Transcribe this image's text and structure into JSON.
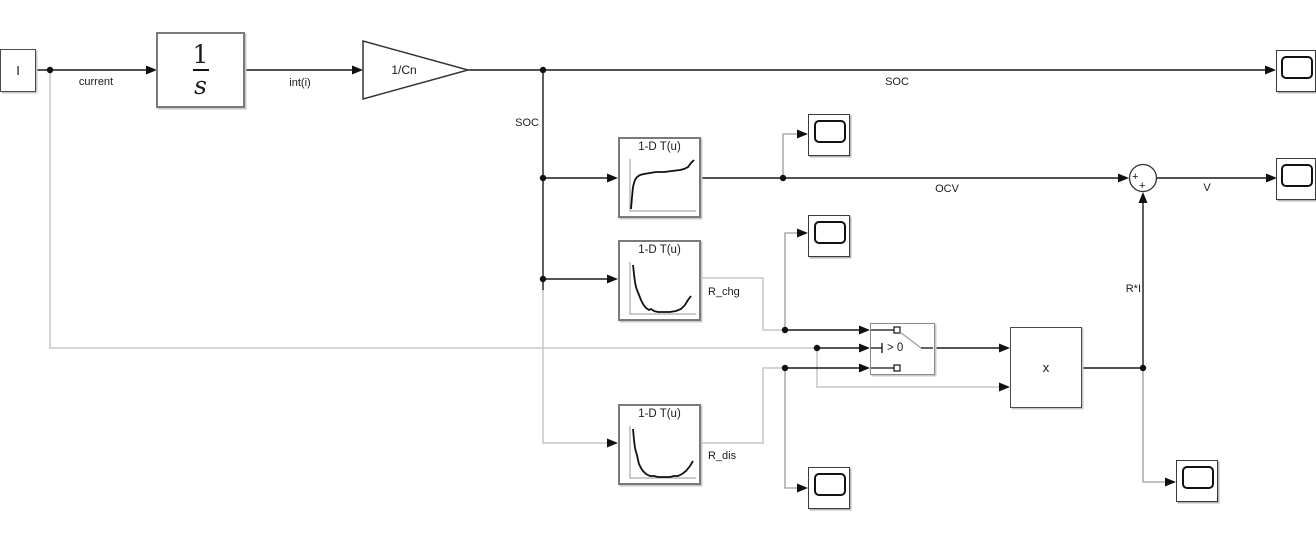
{
  "diagram_title": "battery model block diagram",
  "labels": {
    "current": "current",
    "int_i": "int(i)",
    "soc_branch": "SOC",
    "soc_top": "SOC",
    "ocv": "OCV",
    "r_chg": "R_chg",
    "r_dis": "R_dis",
    "r_times_i": "R*I",
    "v": "V"
  },
  "blocks": {
    "inport": {
      "label": "I"
    },
    "integrator": {
      "numerator": "1",
      "denominator": "s"
    },
    "gain": {
      "label": "1/Cn"
    },
    "luts": [
      {
        "title": "1-D T(u)",
        "curve_path": "M7,52 L8,40 L9,30 L10,26 L11,23 L13,20 L16,18 L20,17 L26,16 L32,15 L40,15 L48,14 L56,13 L60,12 L64,10 L67,6 L70,3",
        "signal": "OCV"
      },
      {
        "title": "1-D T(u)",
        "curve_path": "M9,5 L10,14 L11,22 L12,27 L13,30 L15,35 L17,40 L19,44 L22,48 L25,50 L27,49 L30,51 L34,52 L40,52 L46,52 L52,51 L57,49 L61,45 L64,40 L67,36",
        "signal": "R_chg"
      },
      {
        "title": "1-D T(u)",
        "curve_path": "M9,5 L10,16 L11,24 L12,28 L13,31 L14,36 L15,40 L17,44 L19,47 L22,50 L26,52 L30,52 L34,53 L40,53 L46,53 L50,52 L54,52 L58,50 L62,47 L66,42 L69,37",
        "signal": "R_dis"
      }
    ],
    "switch": {
      "criterion": "> 0"
    },
    "product": {
      "label": "x"
    },
    "sum": {
      "plus_left": "+",
      "plus_bottom": "+"
    }
  },
  "colors": {
    "wire_black": "#1a1a1a",
    "wire_light_gray": "#c6c6c6",
    "wire_medium_gray": "#9c9c9c",
    "block_border": "#7a7a7a",
    "axis_gray": "#b8b8b8",
    "background": "#ffffff"
  }
}
